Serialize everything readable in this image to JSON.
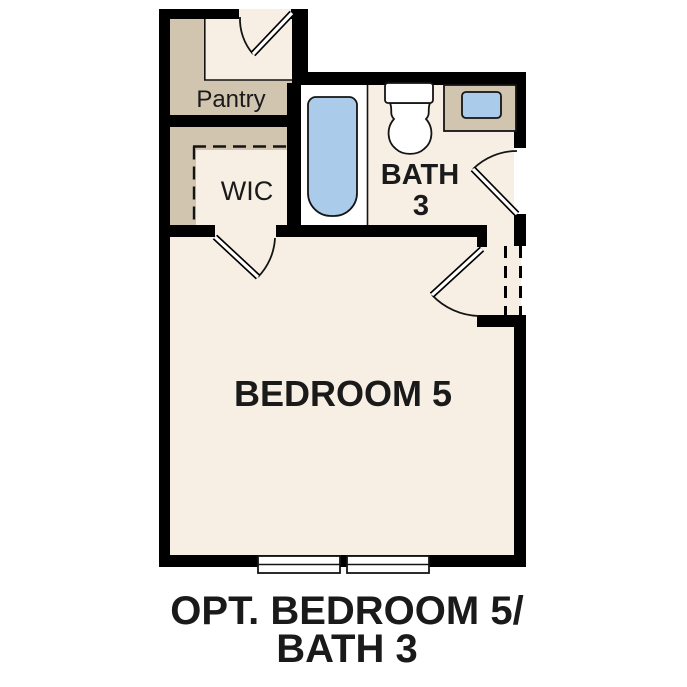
{
  "plan": {
    "rooms": {
      "pantry": "Pantry",
      "wic": "WIC",
      "bath_line1": "BATH",
      "bath_line2": "3",
      "bedroom": "BEDROOM 5"
    },
    "caption": {
      "line1": "OPT. BEDROOM 5/",
      "line2": "BATH 3"
    },
    "fixture_icons": [
      "bathtub-icon",
      "toilet-icon",
      "sink-icon",
      "vanity-icon",
      "window-icon",
      "window-icon",
      "door-swing-icon",
      "door-swing-icon",
      "door-swing-icon",
      "door-swing-icon"
    ],
    "colors": {
      "wall": "#000000",
      "floor": "#f7efe3",
      "tan": "#d1c5b0",
      "fixture_blue": "#aacbea",
      "fixture_white": "#ffffff",
      "line": "#141414",
      "text": "#1a1a1a",
      "background": "#ffffff"
    }
  }
}
